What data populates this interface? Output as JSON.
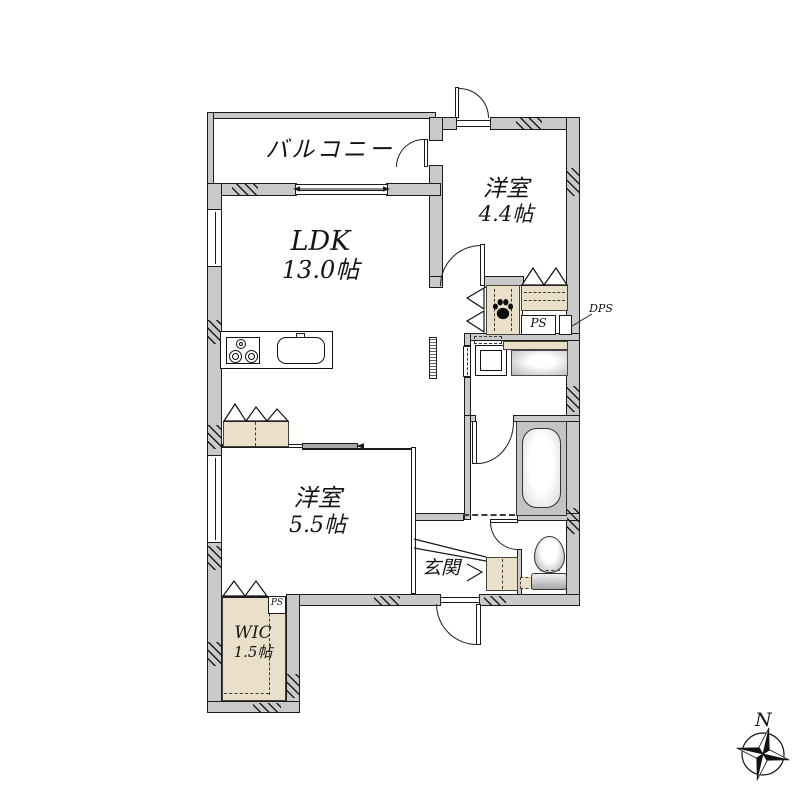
{
  "document": {
    "type": "floor-plan"
  },
  "rooms": {
    "balcony": {
      "name": "バルコニー"
    },
    "bedroom_44": {
      "name": "洋室",
      "size": "4.4帖"
    },
    "ldk": {
      "name": "LDK",
      "size": "13.0帖"
    },
    "bedroom_55": {
      "name": "洋室",
      "size": "5.5帖"
    },
    "wic": {
      "name": "WIC",
      "size": "1.5帖"
    },
    "entrance": {
      "name": "玄関"
    }
  },
  "labels": {
    "pipe_space": "PS",
    "wic_pipe_space": "PS",
    "double_pipe_space": "DPS",
    "compass_north": "N"
  },
  "colors": {
    "wall": "#c9c9c9",
    "closet": "#eadfc9",
    "line": "#1b1b1b",
    "fixture": "#c4c4c4"
  }
}
